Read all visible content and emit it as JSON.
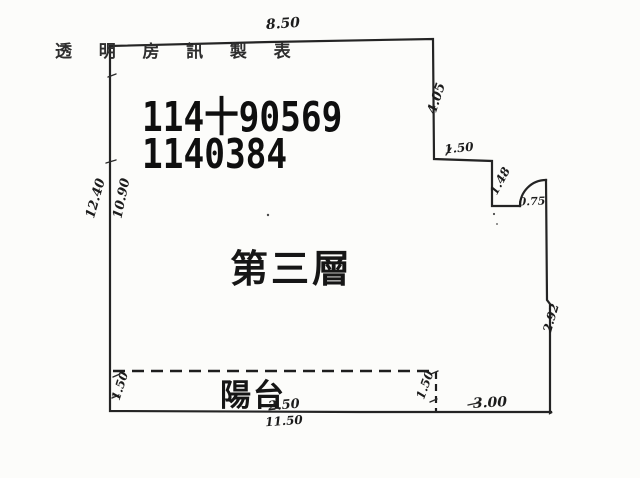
{
  "colors": {
    "ink": "#242424",
    "paper": "#fcfcfa"
  },
  "watermark": {
    "text": "透 明 房 訊 製 表"
  },
  "stamp": {
    "line1": "114十90569",
    "line2": "1140384"
  },
  "rooms": {
    "main_label": "第三層",
    "balcony_label": "陽台"
  },
  "dimensions": {
    "top_width": "8.50",
    "right_upper": "4.05",
    "step_width": "1.50",
    "step_height": "1.48",
    "door_width": "0.75",
    "left_outer_height": "12.40",
    "left_inner_height": "10.90",
    "right_lower_height": "2.92",
    "balcony_left_depth": "1.50",
    "balcony_right_depth": "1.50",
    "balcony_segment": "2.50",
    "bottom_width": "11.50",
    "bottom_right_width": "3.00"
  }
}
